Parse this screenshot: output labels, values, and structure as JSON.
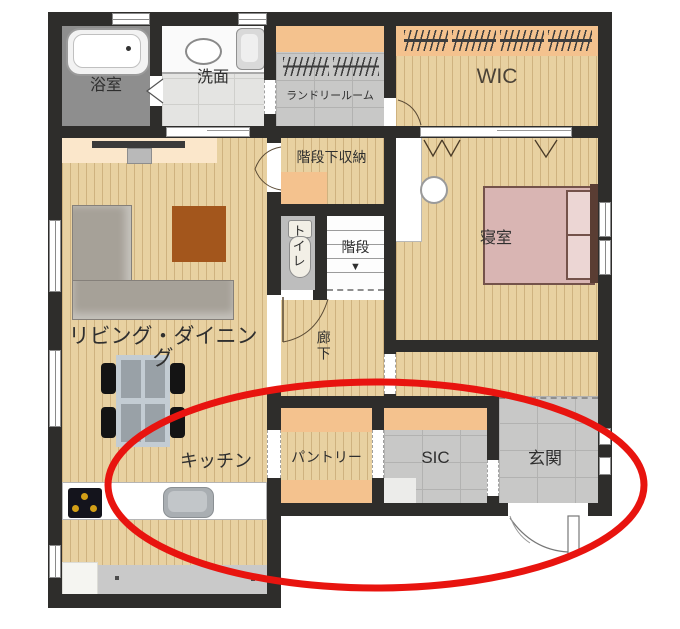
{
  "floorplan": {
    "rooms": {
      "bathroom": {
        "label": "浴室"
      },
      "washroom": {
        "label": "洗面"
      },
      "laundry": {
        "label": "ランドリールーム"
      },
      "wic": {
        "label": "WIC"
      },
      "under_stair_storage": {
        "label": "階段下収納"
      },
      "toilet": {
        "label": "トイレ"
      },
      "stairs": {
        "label": "階段",
        "down_arrow": "▼"
      },
      "bedroom": {
        "label": "寝室"
      },
      "living_dining": {
        "label": "リビング・ダイニング"
      },
      "corridor": {
        "label": "廊下"
      },
      "kitchen": {
        "label": "キッチン"
      },
      "pantry": {
        "label": "パントリー"
      },
      "sic": {
        "label": "SIC"
      },
      "entrance": {
        "label": "玄関"
      }
    },
    "annotation": {
      "shape": "ellipse",
      "color": "#e8140f"
    },
    "colors": {
      "wall": "#2e2d2b",
      "wood_floor": "#e8d1a1",
      "tile_floor": "#c8c8c7",
      "shelf_orange": "#f4c28e",
      "bed_pink": "#d9b5b3",
      "sofa_gray": "#a6a198",
      "rug_brown": "#a3561c"
    }
  }
}
